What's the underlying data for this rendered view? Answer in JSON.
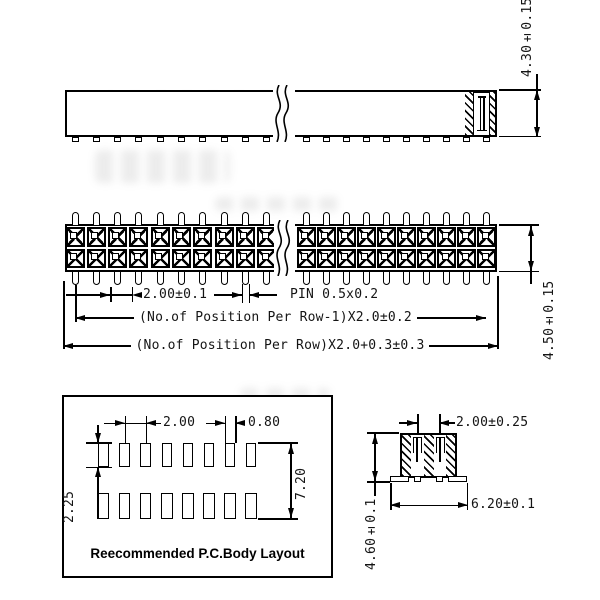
{
  "drawing": {
    "background": "#ffffff",
    "line_color": "#000000",
    "side_view": {
      "height_dim": "4.30±0.15",
      "visible_pin_feet": 20
    },
    "top_view": {
      "pitch_dim": "2.00±0.1",
      "pin_size_dim": "PIN 0.5x0.2",
      "span_minus_one_dim": "(No.of Position Per Row-1)X2.0±0.2",
      "overall_length_dim": "(No.of Position Per Row)X2.0+0.3±0.3",
      "body_width_dim": "4.50±0.15",
      "visible_positions_per_row": 20,
      "rows": 2
    },
    "pc_layout": {
      "title": "Reecommended P.C.Body Layout",
      "pad_pitch_dim": "2.00",
      "pad_width_dim": "0.80",
      "pad_height_dim": "2.25",
      "row_span_dim": "7.20",
      "pads_per_row": 8,
      "rows": 2
    },
    "end_view": {
      "row_pitch_dim": "2.00±0.25",
      "foot_span_dim": "6.20±0.1",
      "height_dim": "4.60±0.1"
    }
  }
}
